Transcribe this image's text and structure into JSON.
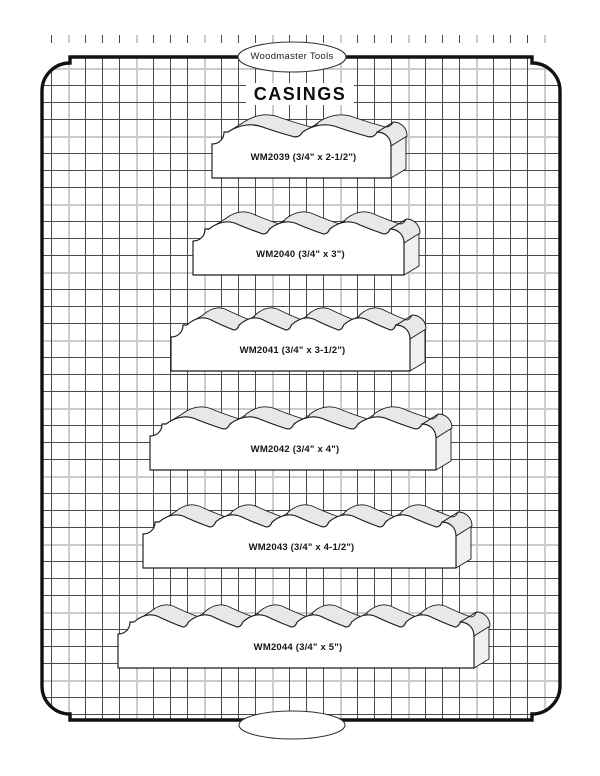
{
  "page": {
    "brand": "Woodmaster Tools",
    "title": "CASINGS",
    "footer_ellipse": ""
  },
  "items": [
    {
      "code": "WM2039",
      "size": "3/4\" x 2-1/2\"",
      "label": "WM2039 (3/4\" x 2-1/2\")",
      "front_w": 183,
      "left": 212,
      "top": 110,
      "scallops": 2
    },
    {
      "code": "WM2040",
      "size": "3/4\" x 3\"",
      "label": "WM2040 (3/4\" x 3\")",
      "front_w": 215,
      "left": 193,
      "top": 207,
      "scallops": 3
    },
    {
      "code": "WM2041",
      "size": "3/4\" x 3-1/2\"",
      "label": "WM2041 (3/4\" x 3-1/2\")",
      "front_w": 243,
      "left": 171,
      "top": 303,
      "scallops": 4
    },
    {
      "code": "WM2042",
      "size": "3/4\" x 4\"",
      "label": "WM2042 (3/4\" x 4\")",
      "front_w": 290,
      "left": 150,
      "top": 402,
      "scallops": 4
    },
    {
      "code": "WM2043",
      "size": "3/4\" x 4-1/2\"",
      "label": "WM2043 (3/4\" x 4-1/2\")",
      "front_w": 317,
      "left": 143,
      "top": 500,
      "scallops": 5
    },
    {
      "code": "WM2044",
      "size": "3/4\" x 5\"",
      "label": "WM2044 (3/4\" x 5\")",
      "front_w": 360,
      "left": 118,
      "top": 600,
      "scallops": 6
    }
  ],
  "colors": {
    "line": "#1a1a1a",
    "border": "#111111",
    "grid_dark": "#4a4a4a",
    "grid_light": "#cccccc",
    "shade_top": "#e8e8e8",
    "shade_end": "#f0f0f0",
    "paper": "#ffffff"
  }
}
